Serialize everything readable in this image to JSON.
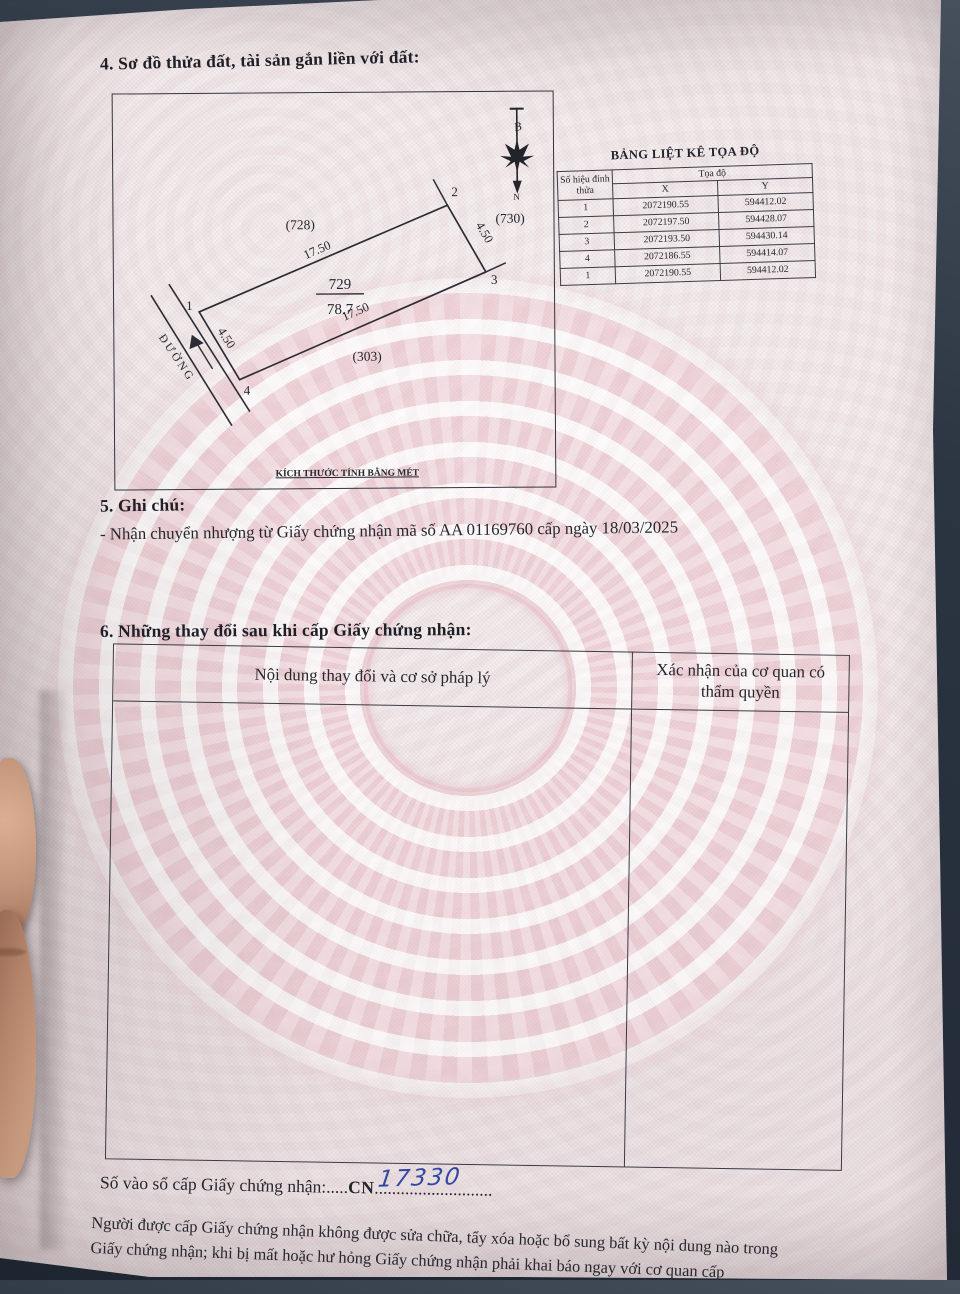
{
  "document": {
    "section4_heading": "4. Sơ đồ thửa đất, tài sản gắn liền với đất:",
    "diagram": {
      "parcel_number": "729",
      "parcel_area": "78.7",
      "neighbor_top": "(728)",
      "neighbor_right": "(730)",
      "neighbor_bottom": "(303)",
      "dim_top": "17.50",
      "dim_bottom": "17.50",
      "dim_left": "4.50",
      "dim_right": "4.50",
      "vertex1": "1",
      "vertex2": "2",
      "vertex3": "3",
      "vertex4": "4",
      "road_label": "ĐƯỜNG",
      "compass_top_letter": "B",
      "compass_bottom_letter": "N",
      "caption": "KÍCH THƯỚC TÍNH BẰNG MÉT"
    },
    "coord_table": {
      "title": "BẢNG LIỆT KÊ TỌA ĐỘ",
      "col_vertex": "Số hiệu đỉnh thửa",
      "col_group": "Tọa độ",
      "col_x": "X",
      "col_y": "Y",
      "rows": [
        {
          "v": "1",
          "x": "2072190.55",
          "y": "594412.02"
        },
        {
          "v": "2",
          "x": "2072197.50",
          "y": "594428.07"
        },
        {
          "v": "3",
          "x": "2072193.50",
          "y": "594430.14"
        },
        {
          "v": "4",
          "x": "2072186.55",
          "y": "594414.07"
        },
        {
          "v": "1",
          "x": "2072190.55",
          "y": "594412.02"
        }
      ]
    },
    "section5_heading": "5. Ghi chú:",
    "section5_note": "- Nhận chuyển nhượng từ Giấy chứng nhận mã số AA 01169760 cấp ngày 18/03/2025",
    "section6_heading": "6. Những thay đổi sau khi cấp Giấy chứng nhận:",
    "section6_col1": "Nội dung thay đổi và cơ sở pháp lý",
    "section6_col2": "Xác nhận của cơ quan có thẩm quyền",
    "serial_label": "Số vào sổ cấp Giấy chứng nhận:",
    "serial_dots_left": ".....",
    "serial_prefix": "CN",
    "serial_number_handwritten": "17330",
    "serial_dots_right": "...........................",
    "warning_line1": "Người được cấp Giấy chứng nhận không được sửa chữa, tẩy xóa hoặc bổ sung bất kỳ nội dung nào trong",
    "warning_line2": "Giấy chứng nhận; khi bị mất hoặc hư hỏng Giấy chứng nhận phải khai báo ngay với cơ quan cấp"
  },
  "colors": {
    "ink": "#26262e",
    "handwriting_blue": "#3247a0",
    "drum_pink": "#e7bac3",
    "paper": "#f3eeee",
    "background_dark": "#232c38"
  }
}
